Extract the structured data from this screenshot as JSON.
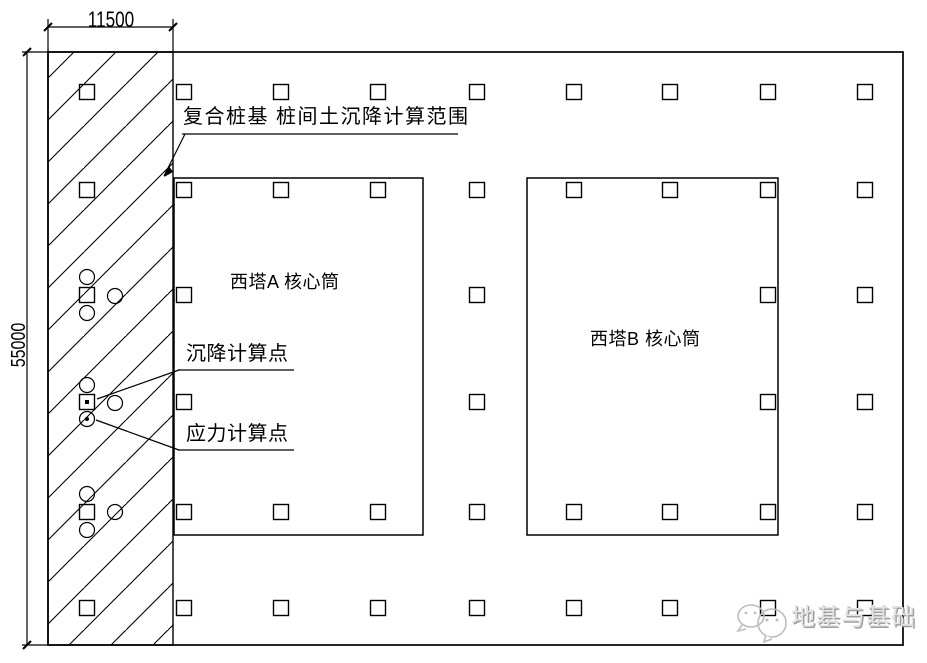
{
  "page": {
    "background": "#ffffff",
    "line_color": "#000000"
  },
  "dimensions": {
    "top_width": "11500",
    "left_height": "55000"
  },
  "annotations": {
    "range_label": "复合桩基 桩间土沉降计算范围",
    "settlement_label": "沉降计算点",
    "stress_label": "应力计算点"
  },
  "towers": {
    "tower_a_label": "西塔A 核心筒",
    "tower_b_label": "西塔B 核心筒"
  },
  "watermark": {
    "text": "地基与基础",
    "icon": "chat-bubbles-icon",
    "color": "#b5b5b5"
  },
  "plan": {
    "pile_grid": {
      "type": "scatter",
      "pile_size": 15,
      "col_centers": [
        87,
        184,
        281,
        378,
        477,
        574,
        670,
        768,
        865
      ],
      "row_centers": [
        92,
        190,
        295,
        402,
        512,
        608
      ],
      "present": [
        [
          1,
          1,
          1,
          1,
          1,
          1,
          1,
          1,
          1
        ],
        [
          1,
          1,
          1,
          1,
          1,
          1,
          1,
          1,
          1
        ],
        [
          1,
          1,
          0,
          0,
          1,
          0,
          0,
          1,
          1
        ],
        [
          1,
          1,
          0,
          0,
          1,
          0,
          0,
          1,
          1
        ],
        [
          1,
          1,
          1,
          1,
          1,
          1,
          1,
          1,
          1
        ],
        [
          1,
          1,
          1,
          1,
          1,
          1,
          1,
          1,
          1
        ]
      ]
    },
    "calc_markers": {
      "circle_radius": 7.5,
      "circles": [
        {
          "cx": 87,
          "cy": 277
        },
        {
          "cx": 115,
          "cy": 296
        },
        {
          "cx": 87,
          "cy": 313
        },
        {
          "cx": 87,
          "cy": 385
        },
        {
          "cx": 115,
          "cy": 403
        },
        {
          "cx": 87,
          "cy": 419,
          "dot": true
        },
        {
          "cx": 87,
          "cy": 494
        },
        {
          "cx": 115,
          "cy": 512
        },
        {
          "cx": 87,
          "cy": 530
        }
      ],
      "settlement_square_dot": {
        "cx": 87,
        "cy": 402
      }
    }
  }
}
